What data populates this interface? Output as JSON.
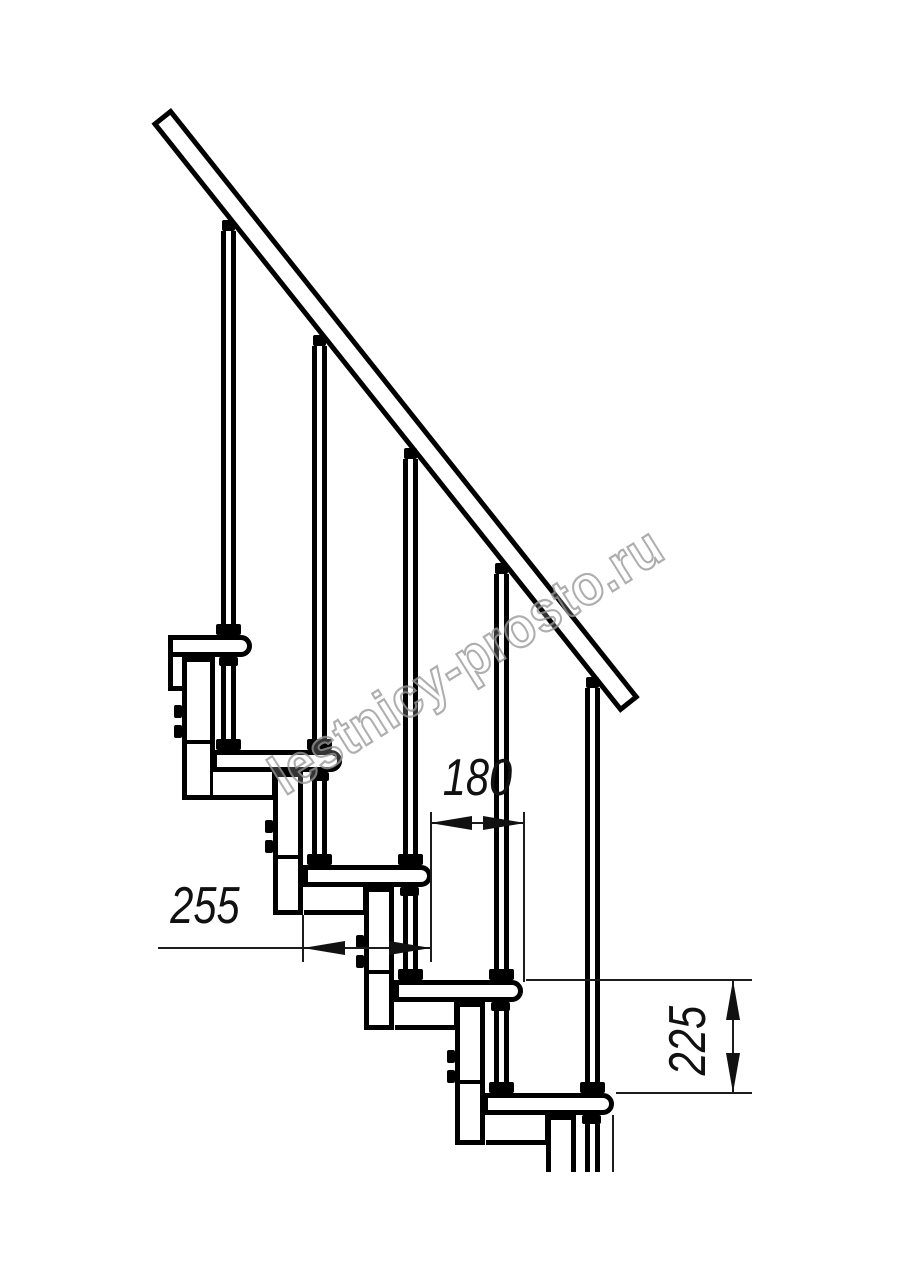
{
  "document": {
    "type": "technical drawing",
    "subject": "modular staircase side elevation fragment",
    "background": "#ffffff",
    "line_color": "#000000"
  },
  "watermark": {
    "text": "lestnicy-prosto.ru",
    "color": "#9a9a9a"
  },
  "dimensions": {
    "run": {
      "value": "180",
      "orientation": "horizontal"
    },
    "depth": {
      "value": "255",
      "orientation": "horizontal"
    },
    "rise": {
      "value": "225",
      "orientation": "vertical"
    }
  }
}
